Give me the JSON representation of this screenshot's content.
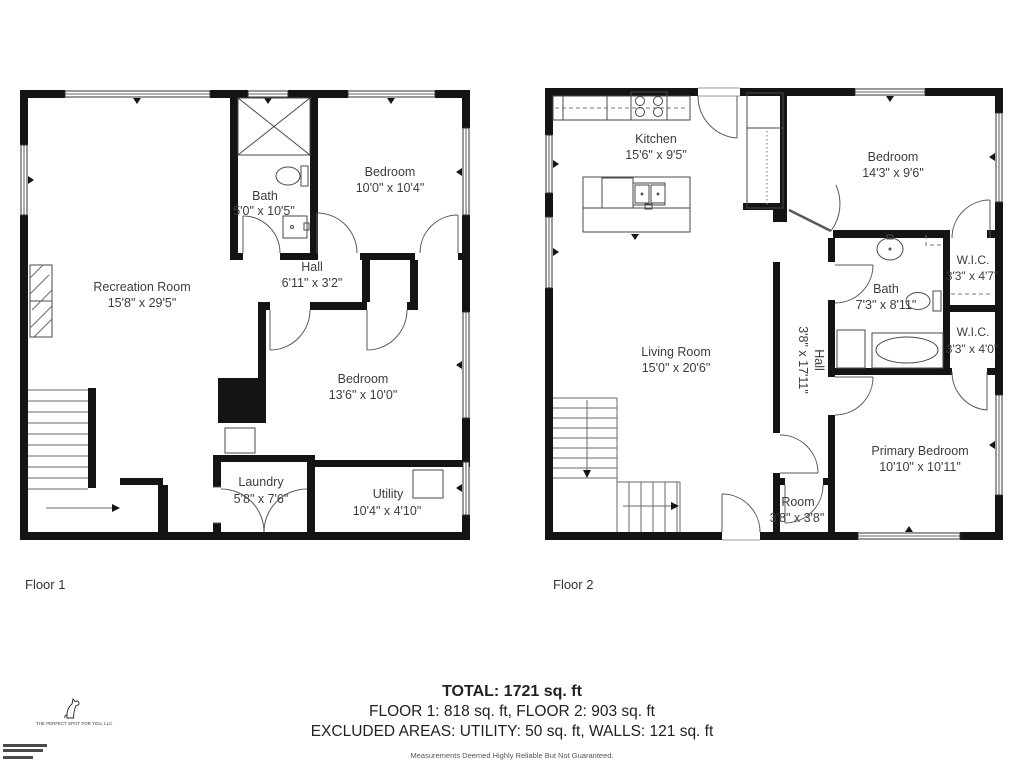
{
  "colors": {
    "walls": "#141414",
    "label_text": "#3d3d3d"
  },
  "floor1": {
    "label": "Floor 1",
    "rooms": {
      "recreation": {
        "name": "Recreation Room",
        "dims": "15'8\" x 29'5\""
      },
      "bath": {
        "name": "Bath",
        "dims": "5'0\" x 10'5\""
      },
      "bedroom1": {
        "name": "Bedroom",
        "dims": "10'0\" x 10'4\""
      },
      "hall": {
        "name": "Hall",
        "dims": "6'11\" x 3'2\""
      },
      "bedroom2": {
        "name": "Bedroom",
        "dims": "13'6\" x 10'0\""
      },
      "laundry": {
        "name": "Laundry",
        "dims": "5'8\" x 7'6\""
      },
      "utility": {
        "name": "Utility",
        "dims": "10'4\" x 4'10\""
      }
    }
  },
  "floor2": {
    "label": "Floor 2",
    "rooms": {
      "kitchen": {
        "name": "Kitchen",
        "dims": "15'6\" x 9'5\""
      },
      "bedroom": {
        "name": "Bedroom",
        "dims": "14'3\" x 9'6\""
      },
      "wic1": {
        "name": "W.I.C.",
        "dims": "3'3\" x 4'7\""
      },
      "bath": {
        "name": "Bath",
        "dims": "7'3\" x 8'11\""
      },
      "wic2": {
        "name": "W.I.C.",
        "dims": "3'3\" x 4'0\""
      },
      "living": {
        "name": "Living Room",
        "dims": "15'0\" x 20'6\""
      },
      "hall": {
        "name": "Hall",
        "dims": "3'8\" x 17'11\""
      },
      "primary": {
        "name": "Primary Bedroom",
        "dims": "10'10\" x 10'11\""
      },
      "room": {
        "name": "Room",
        "dims": "3'8\" x 3'8\""
      }
    }
  },
  "summary": {
    "total": "TOTAL: 1721 sq. ft",
    "floors": "FLOOR 1: 818 sq. ft, FLOOR 2: 903 sq. ft",
    "excluded": "EXCLUDED AREAS: UTILITY: 50 sq. ft, WALLS: 121 sq. ft",
    "disclaimer": "Measurements Deemed Highly Reliable But Not Guaranteed."
  },
  "branding": {
    "company": "THE PERFECT SPOT FOR YOU, LLC"
  }
}
